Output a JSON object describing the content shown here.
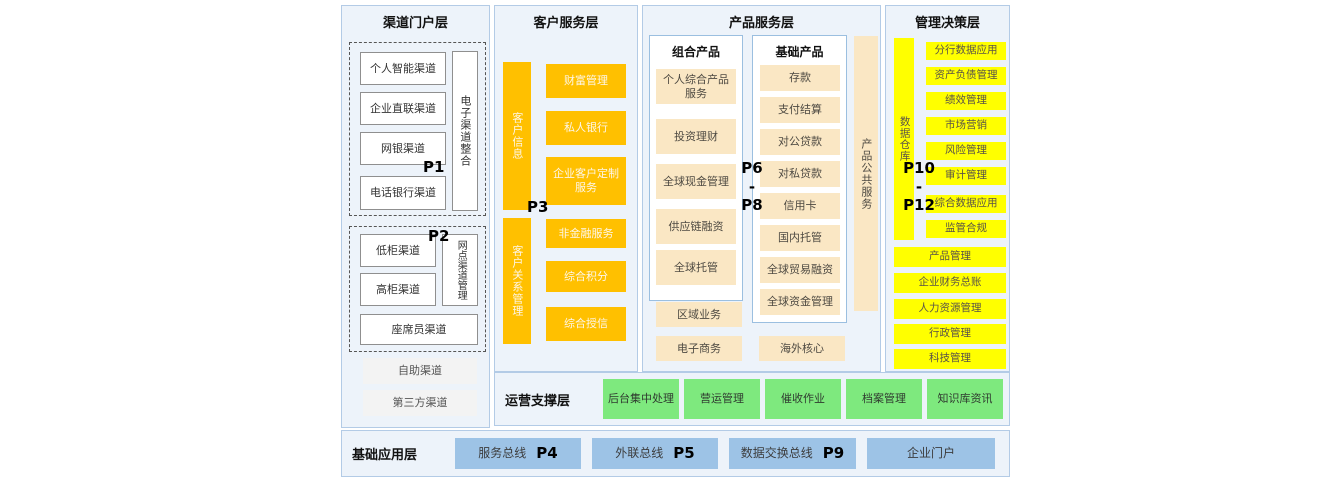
{
  "colors": {
    "accent_orange": "#FFC000",
    "tan": "#FAE7C4",
    "yellow": "#FFFF00",
    "green": "#7EE97E",
    "bus_blue": "#9DC3E6",
    "panel_bg": "#EDF3FA",
    "panel_border": "#B3CBE6"
  },
  "layers": {
    "channel": {
      "title": "渠道门户层",
      "p1": "P1",
      "p2": "P2",
      "group1": {
        "items": [
          "个人智能渠道",
          "企业直联渠道",
          "网银渠道",
          "电话银行渠道"
        ],
        "side": "电子渠道整合"
      },
      "group2": {
        "items": [
          "低柜渠道",
          "高柜渠道"
        ],
        "side": "网点渠道管理",
        "wide": "座席员渠道"
      },
      "extra": [
        "自助渠道",
        "第三方渠道"
      ]
    },
    "customer": {
      "title": "客户服务层",
      "p3": "P3",
      "bar1": "客户信息",
      "bar2": "客户关系管理",
      "top_boxes": [
        "财富管理",
        "私人银行",
        "企业客户定制服务"
      ],
      "bottom_boxes": [
        "非金融服务",
        "综合积分",
        "综合授信"
      ]
    },
    "product": {
      "title": "产品服务层",
      "p_top": "P6",
      "p_dash": "-",
      "p_bottom": "P8",
      "combo": {
        "title": "组合产品",
        "items": [
          "个人综合产品服务",
          "投资理财",
          "全球现金管理",
          "供应链融资",
          "全球托管"
        ]
      },
      "basic": {
        "title": "基础产品",
        "items": [
          "存款",
          "支付结算",
          "对公贷款",
          "对私贷款",
          "信用卡",
          "国内托管",
          "全球贸易融资",
          "全球资金管理"
        ]
      },
      "side": "产品公共服务",
      "extras": [
        "区域业务",
        "电子商务"
      ],
      "overseas": "海外核心"
    },
    "management": {
      "title": "管理决策层",
      "p_top": "P10",
      "p_dash": "-",
      "p_bottom": "P12",
      "bar": "数据仓库",
      "small": [
        "分行数据应用",
        "资产负债管理",
        "绩效管理",
        "市场营销",
        "风险管理",
        "审计管理",
        "综合数据应用",
        "监管合规"
      ],
      "wide": [
        "产品管理",
        "企业财务总账",
        "人力资源管理",
        "行政管理",
        "科技管理"
      ]
    },
    "ops": {
      "title": "运营支撑层",
      "items": [
        "后台集中处理",
        "营运管理",
        "催收作业",
        "档案管理",
        "知识库资讯"
      ]
    },
    "base": {
      "title": "基础应用层",
      "items": [
        {
          "label": "服务总线",
          "p": "P4"
        },
        {
          "label": "外联总线",
          "p": "P5"
        },
        {
          "label": "数据交换总线",
          "p": "P9"
        },
        {
          "label": "企业门户",
          "p": ""
        }
      ]
    }
  }
}
